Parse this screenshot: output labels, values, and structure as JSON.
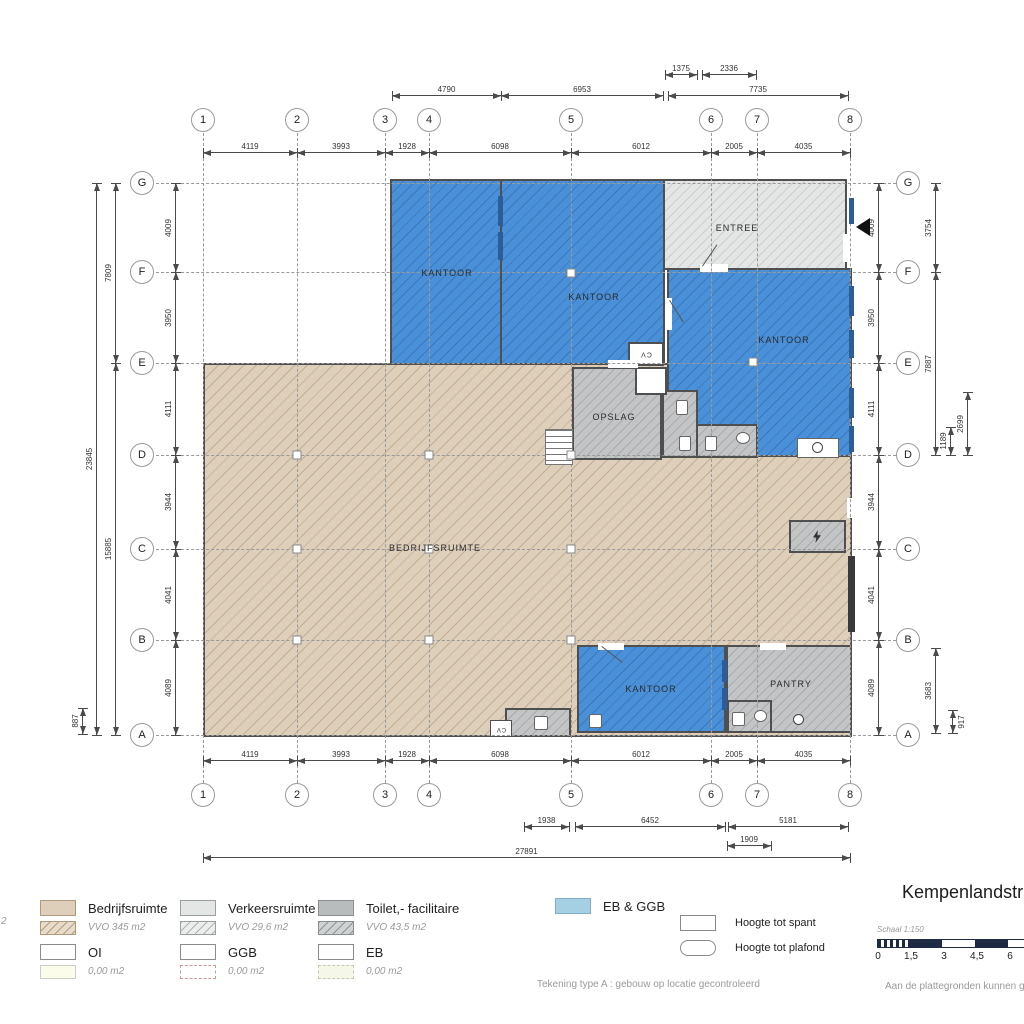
{
  "plan": {
    "cv_label": "CV",
    "rooms": [
      {
        "key": "kantoor-nw",
        "label": "KANTOOR"
      },
      {
        "key": "kantoor-n",
        "label": "KANTOOR"
      },
      {
        "key": "entree",
        "label": "ENTREE"
      },
      {
        "key": "kantoor-e",
        "label": "KANTOOR"
      },
      {
        "key": "opslag",
        "label": "OPSLAG"
      },
      {
        "key": "bedrijfsruimte",
        "label": "BEDRIJFSRUIMTE"
      },
      {
        "key": "kantoor-s",
        "label": "KANTOOR"
      },
      {
        "key": "pantry",
        "label": "PANTRY"
      }
    ]
  },
  "grid": {
    "columns": [
      "1",
      "2",
      "3",
      "4",
      "5",
      "6",
      "7",
      "8"
    ],
    "rows": [
      "G",
      "F",
      "E",
      "D",
      "C",
      "B",
      "A"
    ]
  },
  "dimensions": {
    "top_outer": [
      "1375",
      "2336"
    ],
    "top_mid": [
      "4790",
      "6953",
      "7735"
    ],
    "top_inner": [
      "4119",
      "3993",
      "1928",
      "6098",
      "6012",
      "2005",
      "4035"
    ],
    "bottom_inner": [
      "4119",
      "3993",
      "1928",
      "6098",
      "6012",
      "2005",
      "4035"
    ],
    "bottom_mid": [
      "1938",
      "6452",
      "5181"
    ],
    "bottom_sub": [
      "1909"
    ],
    "bottom_total": [
      "27891"
    ],
    "left_inner": [
      "4009",
      "3950",
      "4111",
      "3944",
      "4041",
      "4089"
    ],
    "left_outer": [
      "7809",
      "15885",
      "23845",
      "887"
    ],
    "right_inner": [
      "4009",
      "3950",
      "4111",
      "3944",
      "4041",
      "4089"
    ],
    "right_outer": [
      "3754",
      "7887",
      "2699",
      "1189",
      "3683",
      "917"
    ]
  },
  "legend": {
    "items": [
      {
        "label": "Bedrijfsruimte",
        "sub": "VVO 345 m2",
        "kind": "bedrijfsruimte"
      },
      {
        "label": "Verkeersruimte",
        "sub": "VVO 29,6 m2",
        "kind": "verkeersruimte"
      },
      {
        "label": "Toilet,- facilitaire",
        "sub": "VVO 43,5 m2",
        "kind": "toilet"
      },
      {
        "label": "EB & GGB",
        "kind": "ebggb"
      },
      {
        "label": "OI",
        "sub": "0,00 m2",
        "kind": "oi"
      },
      {
        "label": "GGB",
        "sub": "0,00 m2",
        "kind": "ggb"
      },
      {
        "label": "EB",
        "sub": "0,00 m2",
        "kind": "eb"
      },
      {
        "label": "Hoogte tot spant",
        "kind": "spant"
      },
      {
        "label": "Hoogte tot plafond",
        "kind": "plafond"
      }
    ],
    "cropped_fragment": "2"
  },
  "titleblock": {
    "title": "Kempenlandstra",
    "scale_label": "Schaal 1:150",
    "scale_ticks": [
      "0",
      "1,5",
      "3",
      "4,5",
      "6"
    ]
  },
  "notes": {
    "drawing_note": "Tekening type A : gebouw op locatie gecontroleerd",
    "rights_note": "Aan de plattegronden kunnen gee"
  },
  "colors": {
    "room_blue": "#4a90d8",
    "room_tan": "#decfba",
    "room_gray": "#c3c4c5",
    "verkeer_gray": "#e4e5e5",
    "legend_blue": "#a5cfe3",
    "scalebar_navy": "#1f2a44"
  }
}
